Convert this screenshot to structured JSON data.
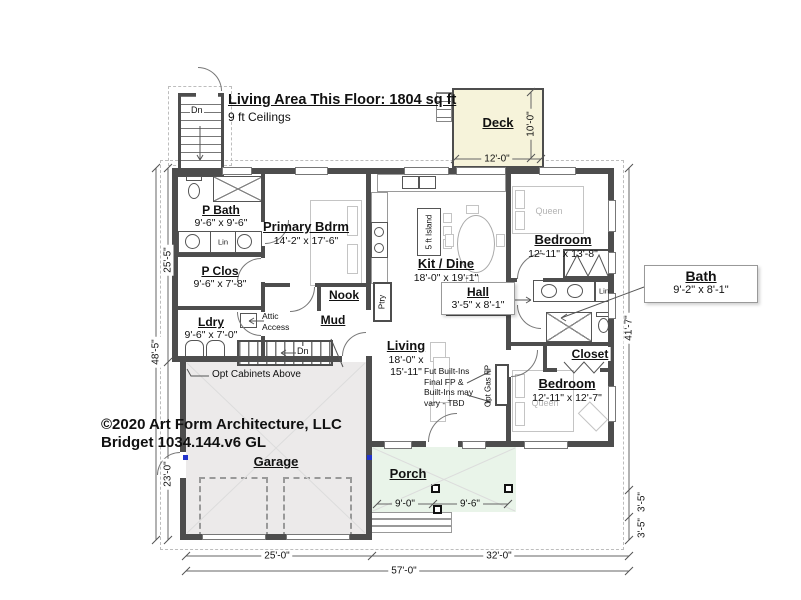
{
  "plan": {
    "title": "Living Area This Floor: 1804 sq ft",
    "subtitle": "9 ft Ceilings",
    "copyright1": "©2020 Art Form Architecture, LLC",
    "copyright2": "Bridget 1034.144.v6 GL"
  },
  "rooms": {
    "pbath": {
      "name": "P Bath",
      "dims": "9'-6\" x 9'-6\""
    },
    "pclos": {
      "name": "P Clos",
      "dims": "9'-6\" x 7'-8\""
    },
    "ldry": {
      "name": "Ldry",
      "dims": "9'-6\" x 7'-0\""
    },
    "primary": {
      "name": "Primary Bdrm",
      "dims": "14'-2\" x 17'-6\""
    },
    "nook": {
      "name": "Nook"
    },
    "mud": {
      "name": "Mud"
    },
    "kitdine": {
      "name": "Kit / Dine",
      "dims": "18'-0\" x 19'-1\""
    },
    "hall": {
      "name": "Hall",
      "dims": "3'-5\" x 8'-1\""
    },
    "living": {
      "name": "Living",
      "dims1": "18'-0\" x",
      "dims2": "15'-11\""
    },
    "bedroom1": {
      "name": "Bedroom",
      "dims": "12'-11\" x 13'-8\""
    },
    "bath": {
      "name": "Bath",
      "dims": "9'-2\" x 8'-1\""
    },
    "closet": {
      "name": "Closet"
    },
    "bedroom2": {
      "name": "Bedroom",
      "dims": "12'-11\" x 12'-7\""
    },
    "garage": {
      "name": "Garage"
    },
    "porch": {
      "name": "Porch"
    },
    "deck": {
      "name": "Deck"
    }
  },
  "fixtures": {
    "island": "5 ft Island",
    "pantry": "Ptry",
    "linen": "Lin",
    "queen": "Queen",
    "down": "Dn",
    "opt_gas_fp": "Opt Gas FP"
  },
  "notes": {
    "attic1": "Attic",
    "attic2": "Access",
    "opt_cabinets": "Opt Cabinets Above",
    "builtins1": "Fut Built-Ins",
    "builtins2": "Final FP &",
    "builtins3": "Built-Ins may",
    "builtins4": "vary - TBD"
  },
  "dims": {
    "left_upper": "25'-5\"",
    "left_total": "48'-5\"",
    "garage_h": "23'-0\"",
    "right_main": "41'-7\"",
    "porch_d1": "3'-5\"",
    "porch_d2": "3'-5\"",
    "garage_w": "25'-0\"",
    "right_w": "32'-0\"",
    "total_w": "57'-0\"",
    "deck_w": "12'-0\"",
    "deck_d": "10'-0\"",
    "porch_w1": "9'-0\"",
    "porch_w2": "9'-6\""
  },
  "colors": {
    "wall": "#4d4d4d",
    "deck_fill": "#f6f3da",
    "porch_fill": "#e9f4e9",
    "garage_fill": "#eceaea",
    "marker_blue": "#2233cc"
  }
}
